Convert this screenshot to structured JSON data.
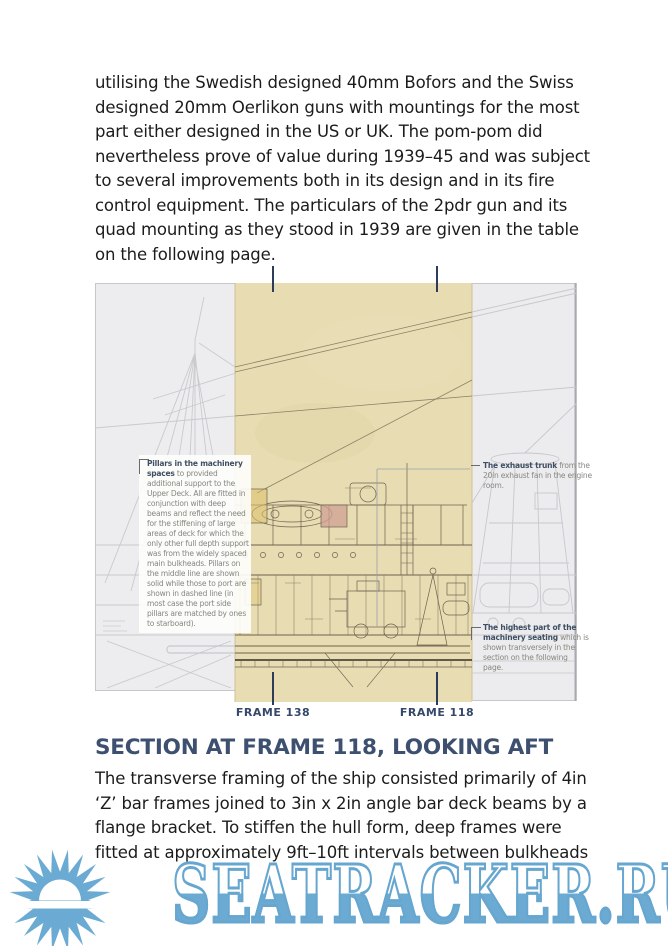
{
  "page": {
    "paragraph1_lines": [
      "utilising the Swedish designed 40mm Bofors and the Swiss",
      "designed 20mm Oerlikon guns with mountings for the most",
      "part either designed in the US or UK. The pom-pom did",
      "nevertheless prove of value during 1939–45 and was subject",
      "to several improvements both in its design and in its fire",
      "control equipment. The particulars of the 2pdr gun and its",
      "quad mounting as they stood in 1939 are given in the table",
      "on the following page."
    ],
    "section": {
      "heading": "SECTION AT FRAME 118, LOOKING AFT",
      "paragraph2_lines": [
        "The transverse framing of the ship consisted primarily of 4in",
        "‘Z’ bar frames joined to 3in x 2in angle bar deck beams by a",
        "flange bracket. To stiffen the hull form, deep frames were",
        "fitted at approximately 9ft–10ft intervals between bulkheads"
      ]
    },
    "figure": {
      "frame_label_left": "FRAME 138",
      "frame_label_right": "FRAME 118",
      "annotations": {
        "pillars": {
          "lead": "Pillars in the machinery spaces",
          "body": " to provided additional support to the Upper Deck. All are fitted in conjunction with deep beams and reflect the need for the stiffening of large areas of deck for which the only other full depth support was from the widely spaced main bulkheads. Pillars on the middle line are shown solid while those to port are shown in dashed line (in most case the port side pillars are matched by ones to starboard)."
        },
        "exhaust": {
          "lead": "The exhaust trunk",
          "body": " from the 20in exhaust fan in the engine room."
        },
        "seating": {
          "lead": "The highest part of the machinery seating",
          "body": " which is shown transversely in the section on the following page."
        }
      }
    },
    "watermark": {
      "text": "SEATRACKER.RU",
      "color": "#6babd3"
    },
    "colors": {
      "heading": "#3d5070",
      "frame_label": "#35486a",
      "tick": "#2c3c59",
      "paper_tan": "#e8dcb2",
      "panel_gray": "#ededef",
      "watermark_blue": "#6babd3"
    }
  }
}
